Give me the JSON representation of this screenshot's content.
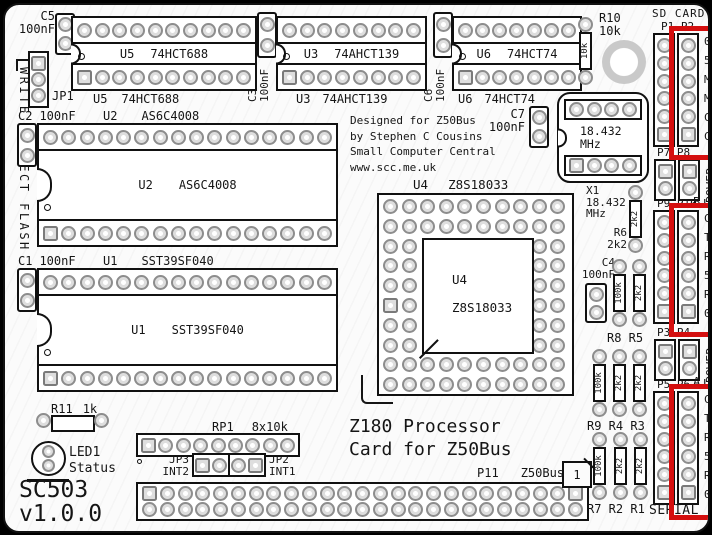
{
  "board": {
    "name": "SC503",
    "version": "v1.0.0",
    "title1": "Z180 Processor",
    "title2": "Card for Z50Bus",
    "credits": [
      "Designed for Z50Bus",
      "by Stephen C Cousins",
      "Small Computer Central",
      "www.scc.me.uk"
    ],
    "write_protect_label": "WRITE PROTECT FLASH"
  },
  "ics": {
    "u5": {
      "ref": "U5",
      "part": "74HCT688"
    },
    "u3": {
      "ref": "U3",
      "part": "74AHCT139"
    },
    "u6": {
      "ref": "U6",
      "part": "74HCT74"
    },
    "u2": {
      "ref": "U2",
      "part": "AS6C4008"
    },
    "u1": {
      "ref": "U1",
      "part": "SST39SF040"
    },
    "u4": {
      "ref": "U4",
      "part": "Z8S18033"
    }
  },
  "caps": {
    "c5": {
      "ref": "C5",
      "value": "100nF"
    },
    "c2": {
      "ref": "C2",
      "value": "100nF"
    },
    "c1": {
      "ref": "C1",
      "value": "100nF"
    },
    "c3": {
      "ref": "C3",
      "value": "100nF"
    },
    "c6": {
      "ref": "C6",
      "value": "100nF"
    },
    "c7": {
      "ref": "C7",
      "value": "100nF"
    },
    "c4": {
      "ref": "C4",
      "value": "100nF"
    }
  },
  "resistors": {
    "r10": {
      "ref": "R10",
      "value": "10k"
    },
    "r11": {
      "ref": "R11",
      "value": "1k"
    },
    "r6": {
      "ref": "R6",
      "value": "2k2"
    },
    "r8": {
      "value": "100k"
    },
    "r5": {
      "value": "2k2"
    },
    "r9": {
      "value": "100k"
    },
    "r4": {
      "value": "2k2"
    },
    "r3": {
      "value": "2k2"
    },
    "r7": {
      "value": "100k"
    },
    "r2": {
      "value": "2k2"
    },
    "r1": {
      "value": "2k2"
    },
    "group1_label": "R8 R5",
    "group2_label": "R9 R4 R3",
    "group3_label": "R7 R2 R1"
  },
  "network": {
    "rp1_ref": "RP1",
    "rp1_value": "8x10k"
  },
  "jumpers": {
    "jp1": "JP1",
    "jp3_ref": "JP3",
    "jp3_label": "INT2",
    "jp2_ref": "JP2",
    "jp2_label": "INT1"
  },
  "led": {
    "ref": "LED1",
    "label": "Status"
  },
  "xtal": {
    "ref": "X1",
    "freq": "18.432",
    "unit": "MHz"
  },
  "headers": {
    "sd_title": "SD CARD",
    "p1p2": "P1 P2",
    "sd_pins": [
      "0V",
      "5V",
      "MI",
      "MO",
      "CL",
      "CS"
    ],
    "p7p8": "P7 P8",
    "power_label": "POWER",
    "power_b_tag": "B",
    "power_a_tag": "A",
    "arrow_down": "↓",
    "p9p10": "P9 P10",
    "uart_pins": [
      "CT",
      "TX",
      "RX",
      "5V",
      "RT",
      "0V"
    ],
    "p3p4": "P3 P4",
    "p5p6": "P5 P6",
    "serial_label": "SERIAL",
    "p11_ref": "P11",
    "p11_label": "Z50Bus",
    "pin1": "1"
  },
  "colors": {
    "highlight": "#d40f0f",
    "silkscreen": "#151515"
  }
}
